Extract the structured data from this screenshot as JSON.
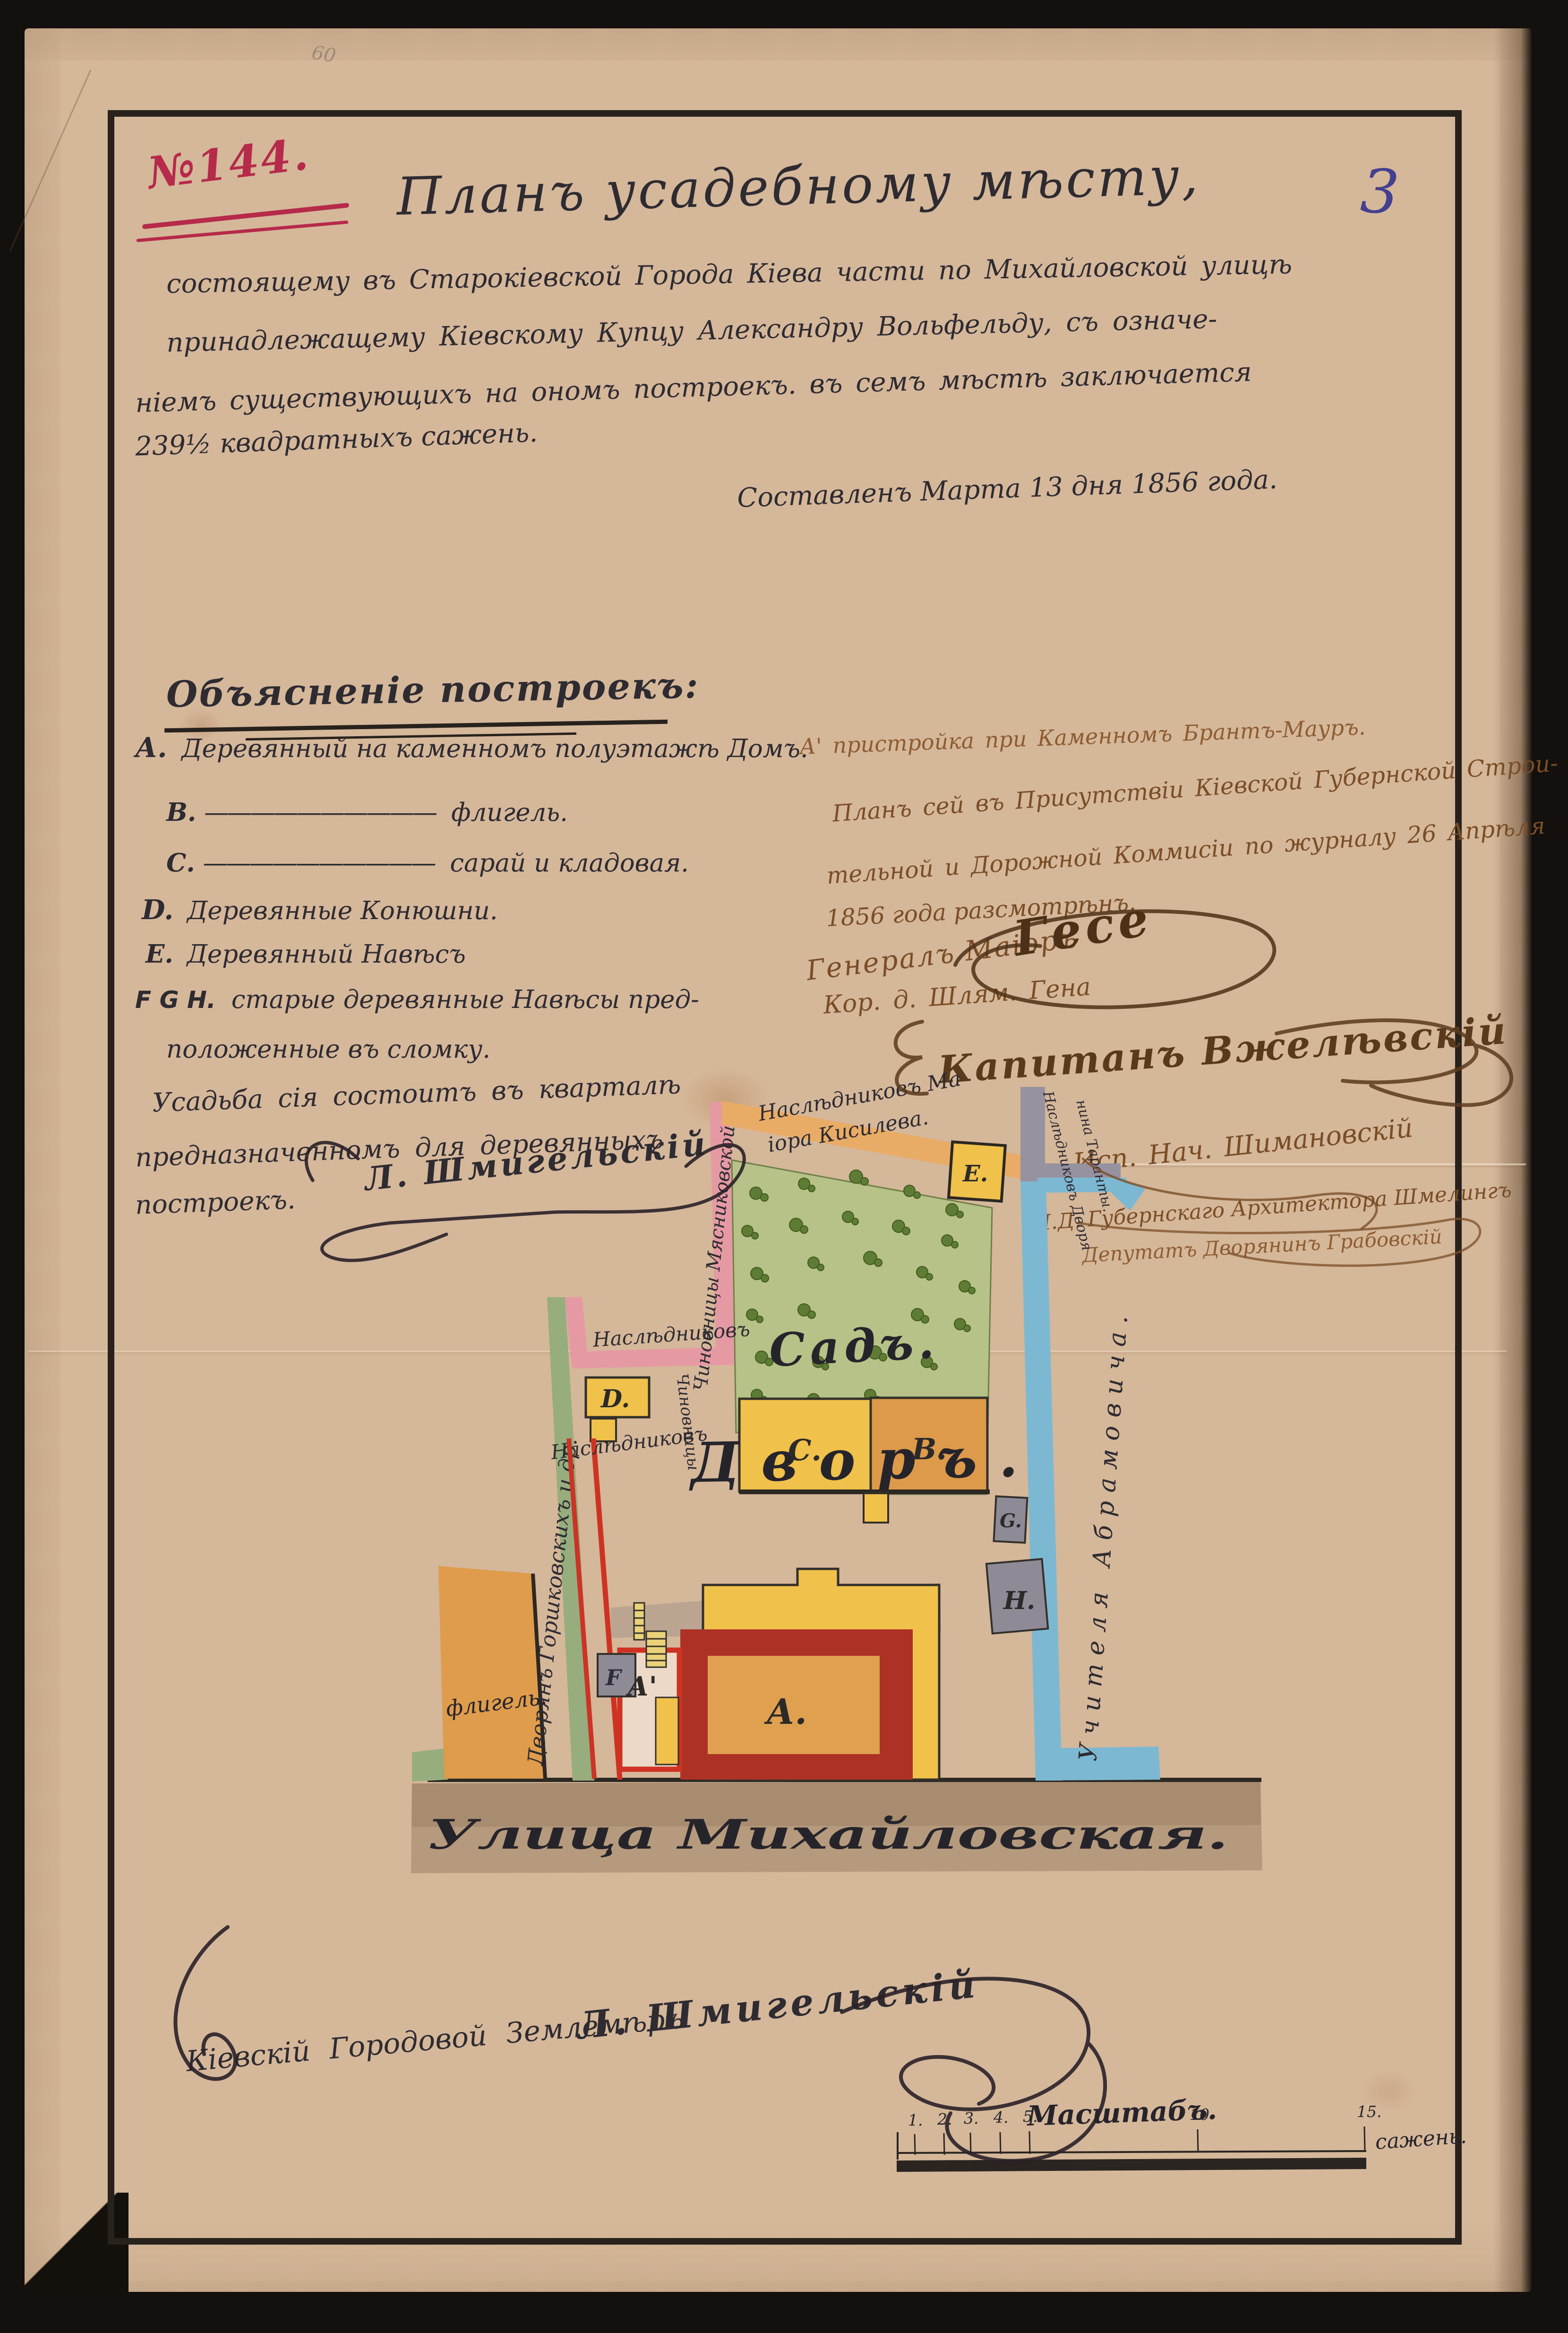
{
  "colors": {
    "paper": "#d5b79a",
    "ink": "#2e2b31",
    "red_stamp": "#b62a4a",
    "blue_page": "#44408f",
    "sepia": "#7a4d26",
    "garden": "#b6c287",
    "tree": "#5e7c33",
    "building_yellow": "#f0c14b",
    "building_orange": "#dd9a4a",
    "building_gray": "#8e8b97",
    "band_pink": "#e59aa3",
    "band_green": "#97ad7d",
    "band_orange": "#e9ac66",
    "band_gray": "#9792a0",
    "band_blue": "#7db8d2",
    "red_line": "#cc3326",
    "crimson": "#ae3125",
    "street": "#b2977b"
  },
  "header": {
    "case_number": "№144.",
    "page_number": "3",
    "title": "Планъ усадебному мѣсту,",
    "intro_lines": [
      "состоящему въ Старокіевской Города Кіева части по Михайловской улицѣ",
      "принадлежащему Кіевскому Купцу Александру Вольфельду, съ означе-",
      "ніемъ существующихъ на ономъ построекъ. въ семъ мѣстѣ заключается",
      "239½ квадратныхъ сажень."
    ],
    "date_line": "Составленъ Марта 13 дня 1856 года."
  },
  "legend": {
    "header": "Объясненіе построекъ:",
    "items": [
      {
        "key": "А.",
        "dash": "",
        "text": "Деревянный на каменномъ полуэтажѣ Домъ."
      },
      {
        "key": "В.",
        "dash": "——————————",
        "text": "флигель."
      },
      {
        "key": "С.",
        "dash": "——————————",
        "text": "сарай и кладовая."
      },
      {
        "key": "D.",
        "dash": "",
        "text": "Деревянные Конюшни."
      },
      {
        "key": "Е.",
        "dash": "",
        "text": "Деревянный Навѣсъ"
      },
      {
        "key": "F G H.",
        "dash": "",
        "text": "старые деревянные Навѣсы пред-"
      },
      {
        "key": "",
        "dash": "",
        "text": "положенные въ сломку."
      }
    ],
    "note_lines": [
      "Усадьба сія состоитъ въ кварталѣ",
      "предназначенномъ для деревянныхъ",
      "построекъ."
    ],
    "surveyor_flourish": "Л. Шмигельскій"
  },
  "annotations": {
    "a_prime_note": "А' пристройка при Каменномъ Брантъ-Мауръ.",
    "commission_lines": [
      "Планъ сей въ Присутствіи Кіевской Губернской Строи-",
      "тельной и Дорожной Коммисіи по журналу 26 Апрѣля",
      "1856 года разсмотрѣнъ."
    ],
    "sig_general_label": "Генералъ Маіоръ",
    "sig_general_name": "Гесе",
    "sig_engineer": "Кор. д. Шлям. Гена",
    "sig_captain": "Капитанъ Вжелѣвскій",
    "sig_chief": "Исп. Нач. Шимановскій",
    "sig_architect": "И.Д. Губернскаго Архитектора Шмелингъ",
    "sig_deputy": "Депутатъ Дворянинъ Грабовскій"
  },
  "plan": {
    "garden_label": "Садъ.",
    "yard_label": "Дворъ.",
    "street_label": "Улица Михайловская.",
    "buildings": [
      {
        "letter": "А."
      },
      {
        "letter": "А'"
      },
      {
        "letter": "В."
      },
      {
        "letter": "С."
      },
      {
        "letter": "D."
      },
      {
        "letter": "Е."
      },
      {
        "letter": "F"
      },
      {
        "letter": "G."
      },
      {
        "letter": "Н."
      }
    ],
    "neighbor_labels": {
      "top_line1": "Наслѣдниковъ Ма",
      "top_line2": "іора Кисилева.",
      "left_pink": "Чиновницы Мясниковской",
      "left_green": "Дворянъ Горшковскихъ и др.",
      "enclave_top": "Наслѣдниковъ",
      "enclave_low": "Наслѣдниковъ",
      "enclave_side": "Чиновницы",
      "right_gray1": "Наслѣдниковъ Дворя",
      "right_gray2": "нина Таранты.",
      "right_blue": "Учителя Абрамовича.",
      "flank": "флигель."
    }
  },
  "scale_bar": {
    "title": "Масштабъ.",
    "ticks": [
      "1.",
      "2.",
      "3.",
      "4.",
      "5.",
      "10",
      "15."
    ],
    "unit": "сажень."
  },
  "footer": {
    "signature_text": "Кіевскій Городовой Землемѣръ",
    "signature_name": "Л. Шмигельскій"
  },
  "misc": {
    "pencil_mark": "60"
  }
}
